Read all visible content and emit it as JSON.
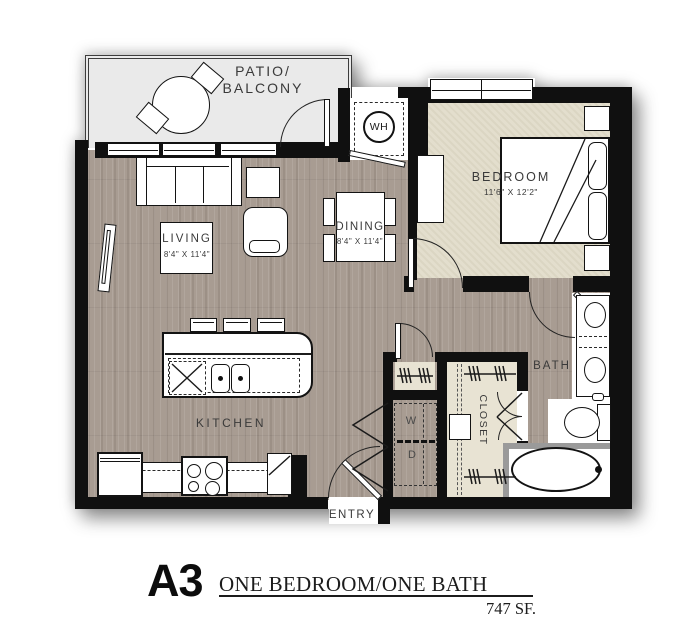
{
  "title": {
    "code": "A3",
    "name": "ONE BEDROOM/ONE BATH",
    "area": "747 SF."
  },
  "rooms": {
    "patio": {
      "label_line1": "PATIO/",
      "label_line2": "BALCONY"
    },
    "living": {
      "label": "LIVING",
      "dimensions": "8'4\" X 11'4\""
    },
    "dining": {
      "label": "DINING",
      "dimensions": "8'4\" X 11'4\""
    },
    "bedroom": {
      "label": "BEDROOM",
      "dimensions": "11'6\" X 12'2\""
    },
    "kitchen": {
      "label": "KITCHEN"
    },
    "bath": {
      "label": "BATH"
    },
    "closet": {
      "label": "CLOSET"
    },
    "entry": {
      "label": "ENTRY"
    }
  },
  "appliances": {
    "water_heater": "WH",
    "washer": "W",
    "dryer": "D"
  },
  "colors": {
    "wall": "#101010",
    "wood_floor": "#a89c92",
    "carpet": "#e3decd",
    "patio_floor": "#eaeaea",
    "closet_floor": "#e8e3d3",
    "label_text": "#3a3a3a",
    "title_text": "#1c1c1c"
  }
}
